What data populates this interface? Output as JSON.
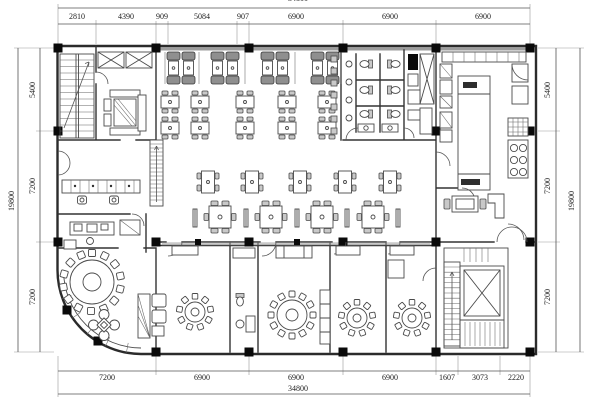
{
  "plan": {
    "type": "restaurant-floor-plan",
    "units": "mm",
    "dimensions": {
      "top": {
        "overall": "34800",
        "segments": [
          "2810",
          "4390",
          "909",
          "5084",
          "907",
          "6900",
          "6900",
          "6900"
        ]
      },
      "bottom": {
        "overall": "34800",
        "segments": [
          "7200",
          "6900",
          "6900",
          "6900",
          "1607",
          "3073",
          "2220"
        ]
      },
      "left": {
        "overall": "19800",
        "segments": [
          "5400",
          "7200",
          "7200"
        ]
      },
      "right": {
        "overall": "19800",
        "segments": [
          "5400",
          "7200",
          "7200"
        ]
      }
    }
  },
  "colors": {
    "background": "#ffffff",
    "wall": "#2b2b2b",
    "partition": "#333333",
    "furniture": "#4a4a4a",
    "column": "#0a0a0a",
    "dimension_line": "#555555",
    "dimension_text": "#1e1e1e"
  }
}
